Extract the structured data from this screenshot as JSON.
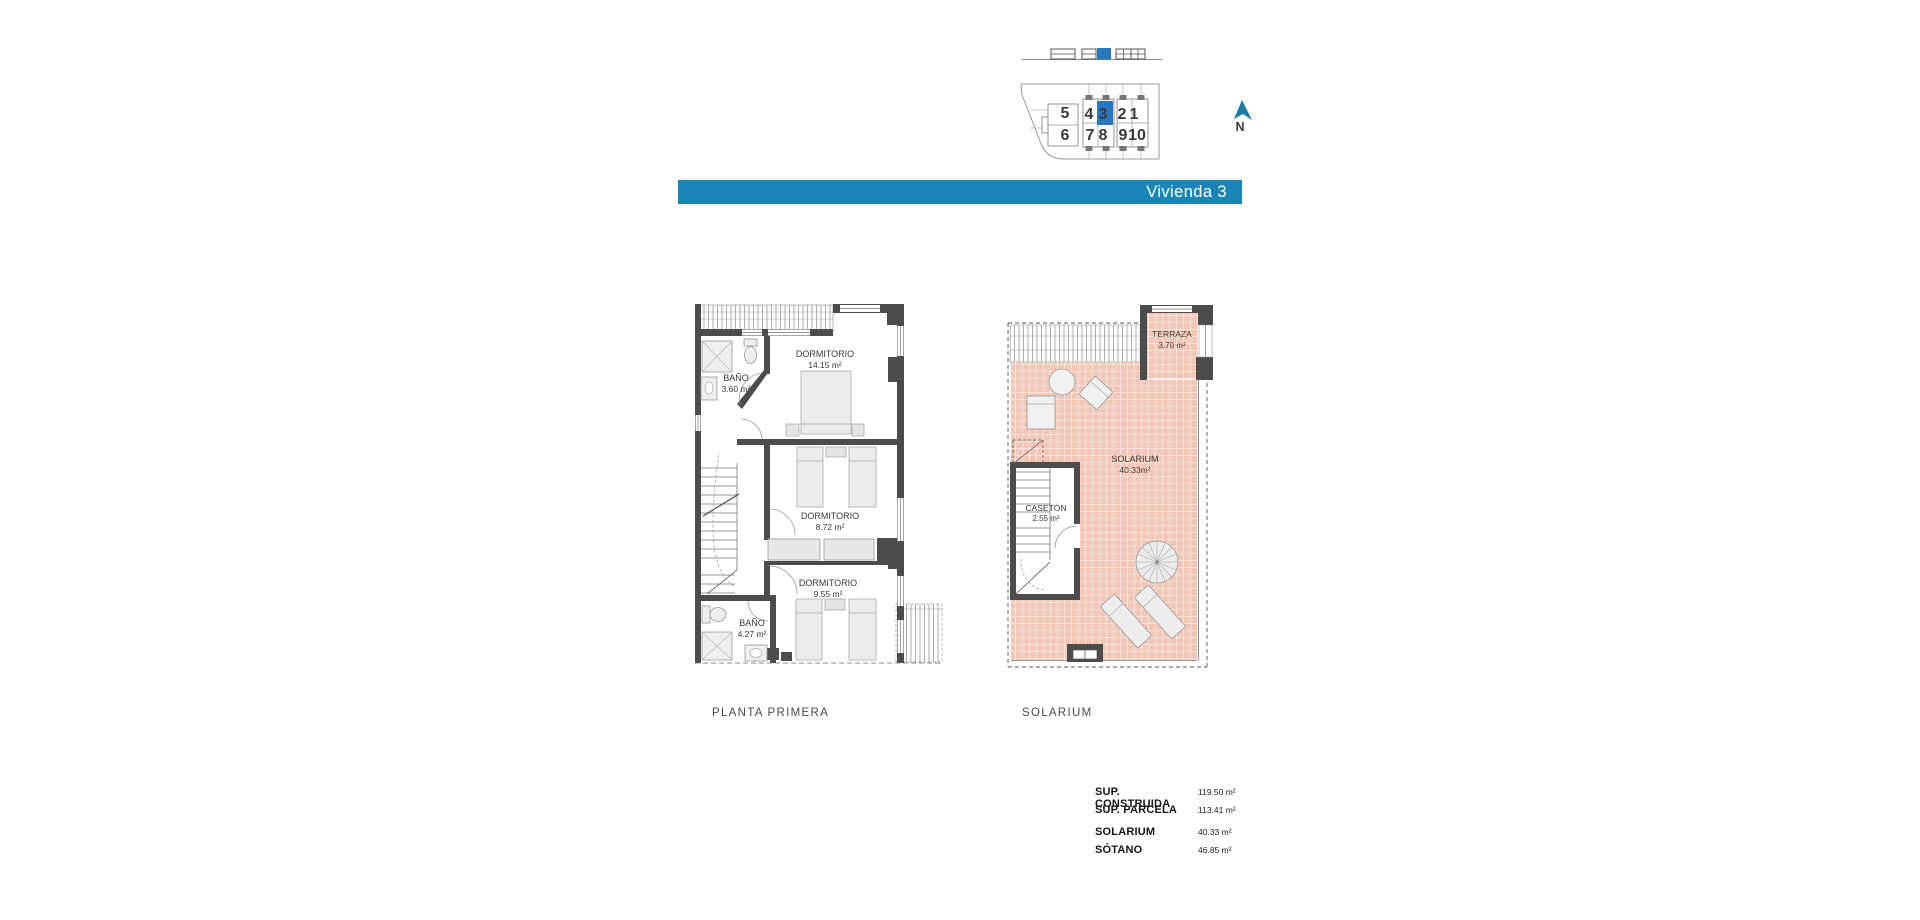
{
  "title_bar": {
    "label": "Vivienda 3"
  },
  "compass": {
    "label": "N"
  },
  "site_plan": {
    "units": [
      "5",
      "4",
      "3",
      "2",
      "1",
      "6",
      "7",
      "8",
      "9",
      "10"
    ],
    "highlighted_unit": "3"
  },
  "floor_plan": {
    "dormitorio_1": {
      "name": "DORMITORIO",
      "area": "14.15 m²"
    },
    "bano_1": {
      "name": "BAÑO",
      "area": "3.60 m²"
    },
    "dormitorio_2": {
      "name": "DORMITORIO",
      "area": "8.72 m²"
    },
    "dormitorio_3": {
      "name": "DORMITORIO",
      "area": "9.55 m²"
    },
    "bano_2": {
      "name": "BAÑO",
      "area": "4.27 m²"
    }
  },
  "solarium_plan": {
    "terraza": {
      "name": "TERRAZA",
      "area": "3.70 m²"
    },
    "solarium": {
      "name": "SOLARIUM",
      "area": "40.33m²"
    },
    "caseton": {
      "name": "CASETÓN",
      "area": "2.55 m²"
    }
  },
  "plan_labels": {
    "left": "PLANTA PRIMERA",
    "right": "SOLARIUM"
  },
  "summary": {
    "rows": [
      {
        "label": "SUP. CONSTRUIDA",
        "value": "119.50 m²"
      },
      {
        "label": "SUP. PARCELA",
        "value": "113.41 m²"
      },
      {
        "label": "SOLARIUM",
        "value": "40.33 m²"
      },
      {
        "label": "SÓTANO",
        "value": "46.85 m²"
      }
    ]
  },
  "colors": {
    "accent_blue": "#1a86b7",
    "highlight_blue": "#2878be",
    "unit_number_red": "#a23a30",
    "tile_pink": "#f3c6b5",
    "wall_gray": "#4c4c4c",
    "north_arrow_blue": "#1d7ca3"
  }
}
